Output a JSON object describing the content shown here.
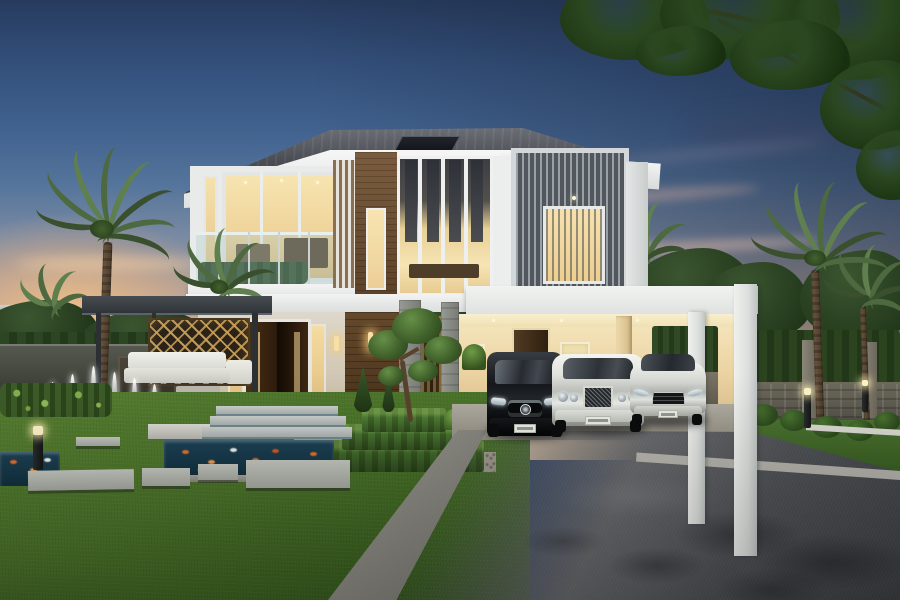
{
  "scene": {
    "alt_text": "Luxury modern two-storey villa at dusk with palm trees, fountain pool, koi pond, manicured garden, lawn and three cars parked under a carport",
    "time_of_day": "dusk",
    "counts": {
      "cars": 3,
      "fountain_jets": 6,
      "palm_trees": 5,
      "bollard_lights": 3
    },
    "objects": [
      "dusk-sky",
      "sunset-glow",
      "cloud-streaks",
      "overhanging-tree-branches",
      "perimeter-wall",
      "hedge-wall",
      "palm-trees",
      "house",
      "hip-roof",
      "skylight-panel",
      "balcony",
      "glass-railing",
      "wood-cladding",
      "louver-screen-box",
      "lit-windows",
      "entrance-double-door",
      "wall-sconces",
      "entry-steps",
      "carport",
      "carport-canopy",
      "white-portal-frame",
      "pergola",
      "outdoor-sofa",
      "carved-gold-screen",
      "wood-deck",
      "fountain-pool",
      "fountain-jets",
      "koi-pond",
      "koi-fish",
      "tiered-hedges",
      "topiary-tree",
      "conical-shrubs",
      "lawn",
      "stepping-stones",
      "driveway",
      "black-suv",
      "white-sedan",
      "silver-coupe",
      "bollard-lights"
    ]
  },
  "palette": {
    "sky_top": "#273b5e",
    "sky_mid": "#54749b",
    "sky_horizon": "#ecd4b4",
    "sunset_glow": "#f5bd8e",
    "roof_dark": "#34373c",
    "wall_white": "#eceeed",
    "wood_brown": "#6e5138",
    "window_warm_light": "#f7e2ae",
    "louver_gray": "#51575c",
    "hedge_green": "#2f4a24",
    "lawn_green": "#4b7429",
    "pool_water": "#2a6580",
    "pond_water": "#12303f",
    "koi_orange": "#e8702d",
    "driveway_light": "#9a988f",
    "driveway_dark": "#3d4045",
    "carport_warm": "#ecd5a4",
    "gold_screen": "#c8a058",
    "car_black": "#0e1013",
    "car_white": "#e9eae6"
  }
}
